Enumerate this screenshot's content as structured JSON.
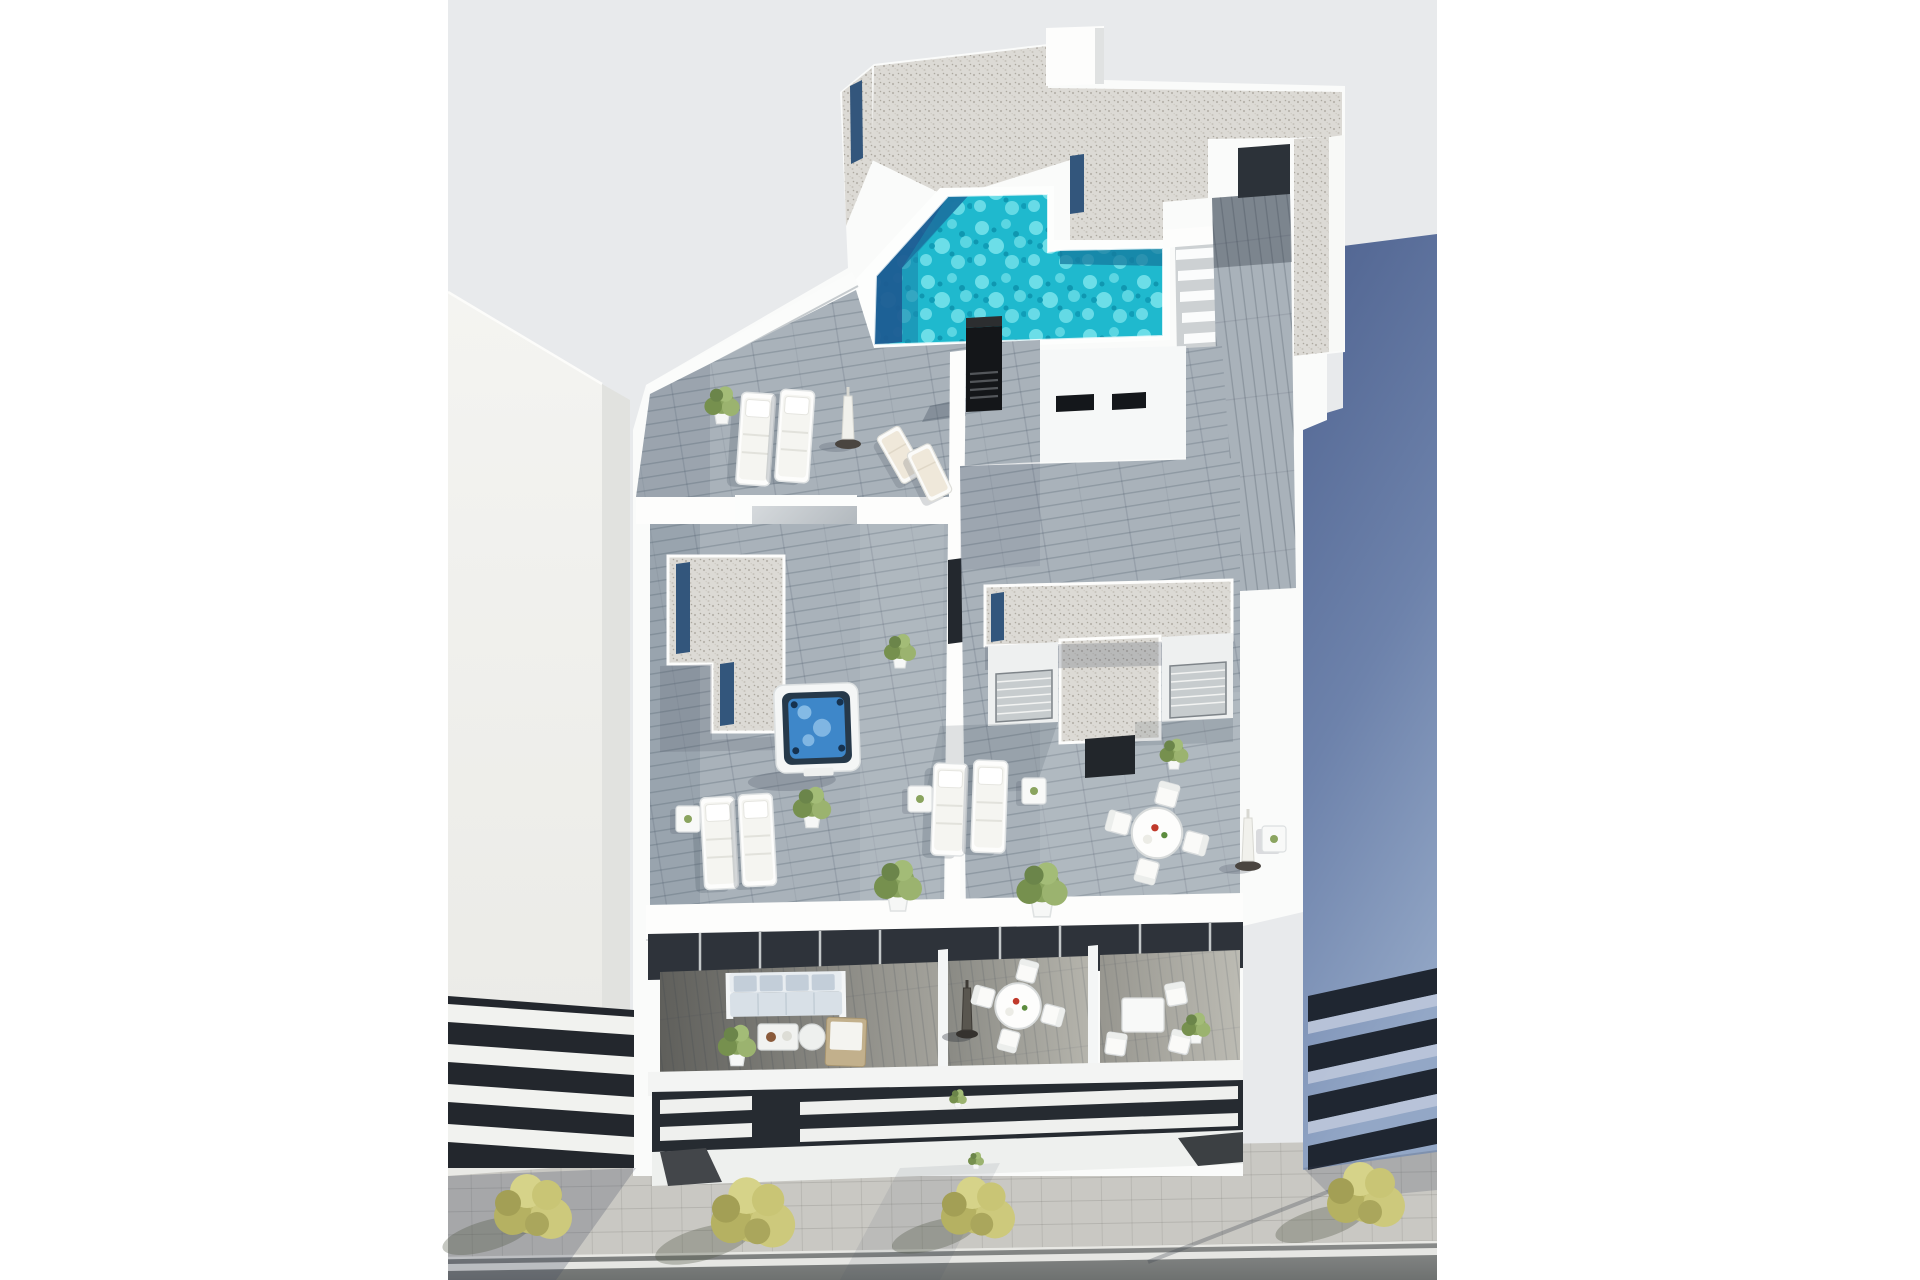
{
  "meta": {
    "type": "architectural-3d-render",
    "view": "high-angle aerial view",
    "subject": "modern white apartment building rooftop with swimming pool, terraces and street"
  },
  "palette": {
    "pageBg": "#ffffff",
    "photoBg": "#e8eaec",
    "wall": "#fafbfa",
    "wallBright": "#fdfdfc",
    "wallShade": "#e7e9e9",
    "wallDark": "#dfe1e0",
    "deck": "#a9b2ba",
    "deckDark": "#64635e",
    "water": "#1fb9ce",
    "waterDeep": "#157a9e",
    "navy": "#1e5c92",
    "glassNavy": "#33567c",
    "gravel": "#dcdad5",
    "towerTop": "#50648f",
    "towerBottom": "#93a7c6",
    "bandDark": "#1f2631",
    "bandLight": "#bcc7da",
    "road": "#7e807f",
    "sidewalk": "#c9c8c3",
    "laneLine": "#efefeb",
    "treeOlive": "#c3bf6f",
    "glazing": "#2e333a",
    "sofaCushion": "#c3ced9",
    "chimney": "#141619",
    "jacuzziWater": "#3e87c9",
    "slatDark": "#262b31",
    "slatWhite": "#eff0ee"
  },
  "scene": {
    "rooftop": {
      "pool": {
        "shape": "irregular-l",
        "finish": "turquoise water with deep navy shadow edge"
      },
      "jacuzzi_count": 1,
      "sun_lounger_count": 6,
      "deck_chair_count": 2,
      "parasol_count": 3,
      "dining_set_count": 2,
      "gravel_roof_decks": 4,
      "stair_flights": 1,
      "chimney_count": 1
    },
    "facade": {
      "terraces": 3,
      "sofa_sets": 1,
      "round_dining_sets": 1,
      "bistro_sets": 1,
      "louver_balcony_rows": 2
    },
    "street": {
      "trees": 4,
      "sidewalk": true,
      "road": true,
      "lane_line": true
    },
    "neighbors": {
      "left": "light concrete building with louvered balconies",
      "right": "blue-grey tower with ribbon window bands"
    }
  },
  "placements": {
    "trees": [
      {
        "x": 533,
        "y": 1208,
        "s": 1.0
      },
      {
        "x": 753,
        "y": 1214,
        "s": 1.08
      },
      {
        "x": 978,
        "y": 1209,
        "s": 0.95
      },
      {
        "x": 1366,
        "y": 1196,
        "s": 1.0
      }
    ],
    "loungers": [
      {
        "x": 742,
        "y": 392,
        "r": 4
      },
      {
        "x": 781,
        "y": 389,
        "r": 4
      },
      {
        "x": 700,
        "y": 798,
        "r": -3
      },
      {
        "x": 738,
        "y": 795,
        "r": -3
      },
      {
        "x": 934,
        "y": 763,
        "r": 2
      },
      {
        "x": 974,
        "y": 760,
        "r": 2
      }
    ],
    "deck_chairs": [
      {
        "x": 876,
        "y": 438,
        "r": -30
      },
      {
        "x": 906,
        "y": 454,
        "r": -26
      }
    ],
    "parasols": [
      {
        "x": 848,
        "y": 444,
        "v": "light"
      },
      {
        "x": 1248,
        "y": 866,
        "v": "light"
      },
      {
        "x": 967,
        "y": 1034,
        "v": "dark"
      }
    ],
    "side_tables": [
      {
        "x": 676,
        "y": 806
      },
      {
        "x": 908,
        "y": 786
      },
      {
        "x": 1022,
        "y": 778
      },
      {
        "x": 1262,
        "y": 826
      }
    ],
    "bushes": [
      {
        "x": 722,
        "y": 404,
        "s": 1.1
      },
      {
        "x": 812,
        "y": 806,
        "s": 1.2
      },
      {
        "x": 900,
        "y": 650,
        "s": 1.0
      },
      {
        "x": 1174,
        "y": 753,
        "s": 0.9
      },
      {
        "x": 898,
        "y": 884,
        "s": 1.5
      },
      {
        "x": 1042,
        "y": 888,
        "s": 1.6
      },
      {
        "x": 737,
        "y": 1044,
        "s": 1.2
      },
      {
        "x": 1196,
        "y": 1027,
        "s": 0.9
      },
      {
        "x": 958,
        "y": 1098,
        "s": 0.55
      },
      {
        "x": 976,
        "y": 1160,
        "s": 0.5
      }
    ],
    "dining_sets": [
      {
        "x": 1157,
        "y": 833,
        "s": 1.05
      },
      {
        "x": 1018,
        "y": 1006,
        "s": 0.95
      }
    ]
  }
}
